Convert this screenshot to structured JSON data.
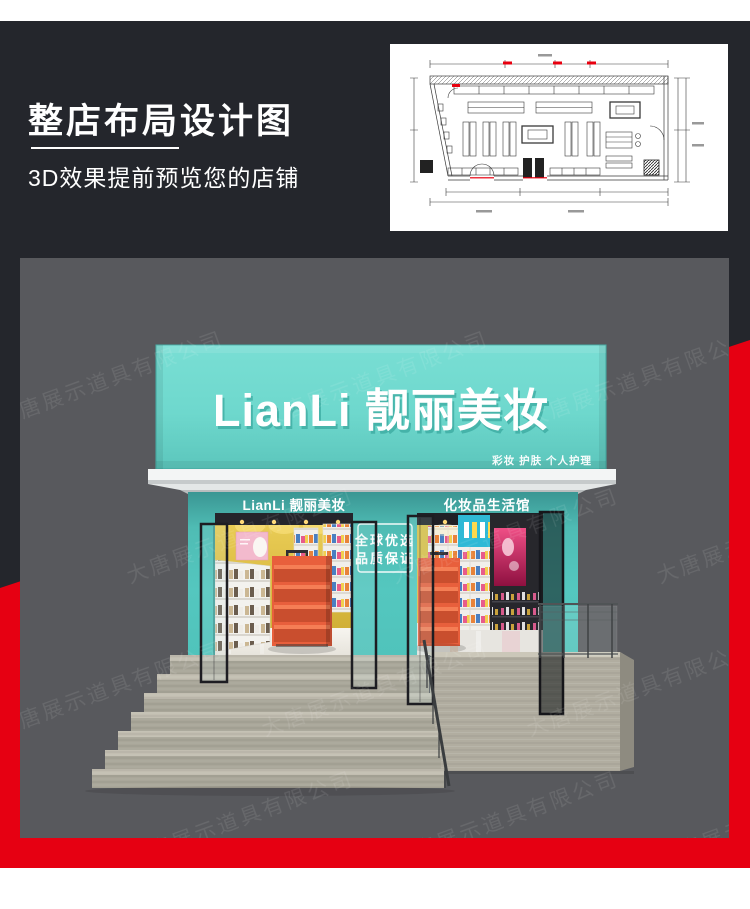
{
  "hero": {
    "title": "整店布局设计图",
    "subtitle": "3D效果提前预览您的店铺"
  },
  "storefront": {
    "sign_text": "LianLi 靓丽美妆",
    "sign_tagline": "彩妆 护肤 个人护理",
    "left_door_header": "LianLi 靓丽美妆",
    "right_door_header": "化妆品生活馆",
    "hanging_sign_line1": "全球优选",
    "hanging_sign_line2": "品质保证"
  },
  "watermark": {
    "text": "大唐展示道具有限公司"
  },
  "colors": {
    "charcoal_bg": "#24262c",
    "panel_gray": "#58595d",
    "accent_red": "#e60012",
    "sign_teal": "#6ed8cd",
    "facade_teal": "#54c7bf",
    "plan_red_mark": "#e8000f"
  }
}
